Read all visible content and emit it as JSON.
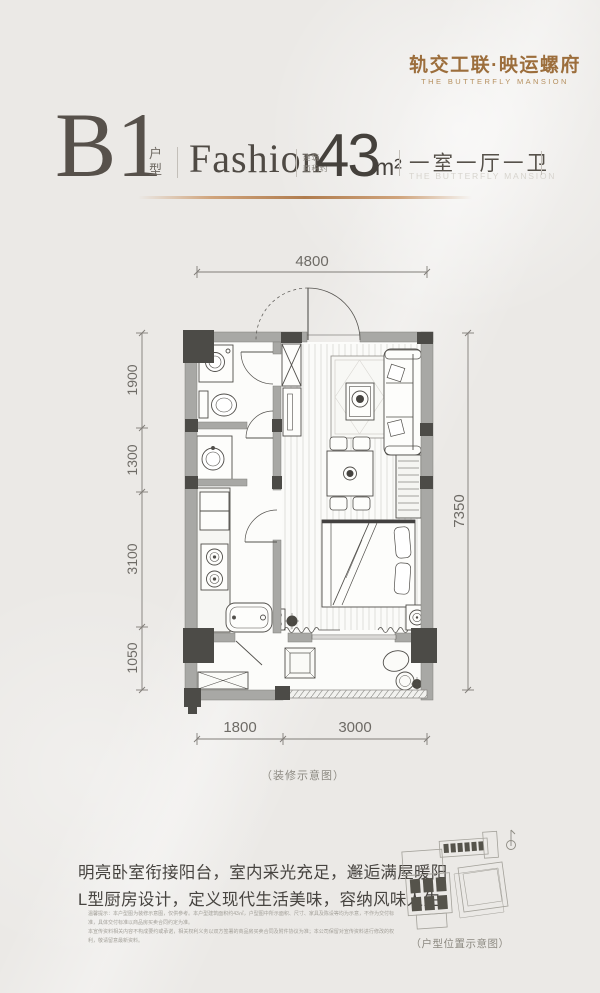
{
  "logo": {
    "title": "轨交工联·映运螺府",
    "subtitle": "THE BUTTERFLY MANSION"
  },
  "header": {
    "unit_code": "B1",
    "unit_label": "户型",
    "style_name": "Fashion",
    "area_label_line1": "建筑",
    "area_label_line2": "面积约",
    "area_value": "43",
    "area_unit": "m²",
    "rooms_label": "一室一厅一卫",
    "rooms_sublabel": "THE BUTTERFLY MANSION"
  },
  "floorplan": {
    "caption": "（装修示意图）",
    "dim_top": "4800",
    "dim_left_1": "1900",
    "dim_left_2": "1300",
    "dim_left_3": "3100",
    "dim_left_4": "1050",
    "dim_right": "7350",
    "dim_bottom_1": "1800",
    "dim_bottom_2": "3000"
  },
  "description": {
    "line1": "明亮卧室衔接阳台，室内采光充足，邂逅满屋暖阳",
    "line2": "L型厨房设计，定义现代生活美味，容纳风味人生",
    "disclaimer1": "温馨提示：本户型图为装修示意图，仅供参考。本户型建筑面积约43㎡，户型图中所示面积、尺寸、家具及陈设等均为示意，不作为交付标准，具体交付标准以商品房买卖合同约定为准。",
    "disclaimer2": "本宣传资料相关内容不构成要约或承诺，相关权利义务以双方签署的商品房买卖合同及附件协议为准；本公司保留对宣传资料进行修改的权利，敬请留意最新资料。"
  },
  "sitemap": {
    "caption": "（户型位置示意图）"
  },
  "colors": {
    "gold": "#9c6e3c",
    "ink": "#57514b",
    "dim_text": "#6e6b66",
    "wall": "#a8a8a5",
    "column": "#4c4b47"
  }
}
